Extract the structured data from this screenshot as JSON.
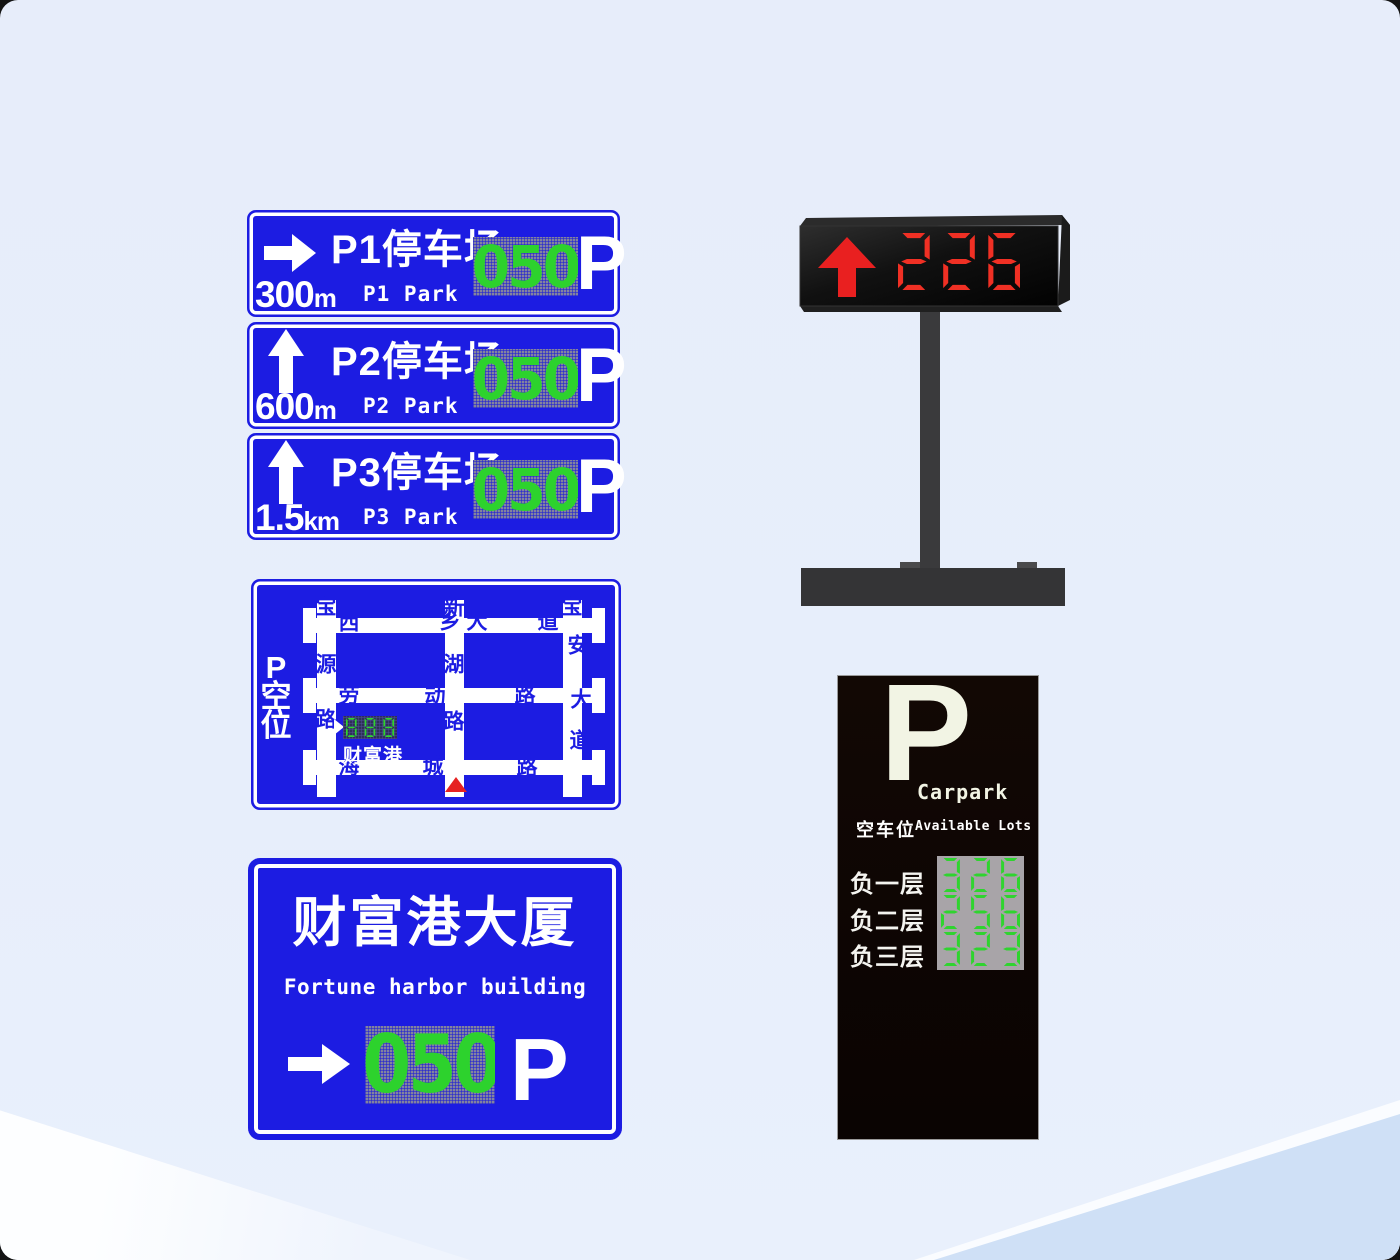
{
  "background": {
    "base": "#e7edfa",
    "wedge_left": "#fdfeff",
    "corner_right": "#cfe0f6"
  },
  "colors": {
    "sign_blue": "#1c1ce2",
    "sign_green": "#2dd22d",
    "led_red": "#f03024",
    "panel_gray": "#83839e",
    "totem_black": "#0d0503",
    "totem_cream": "#f2f4e4",
    "totem_panel_gray": "#a8a4a8",
    "marker_red": "#e62222",
    "pole_gray": "#3a3a3c"
  },
  "direction_signs": [
    {
      "arrow": "right",
      "distance": "300",
      "unit": "m",
      "name_cn": "P1停车场",
      "name_en": "P1 Park",
      "available": "050",
      "parking_symbol": "P"
    },
    {
      "arrow": "up",
      "distance": "600",
      "unit": "m",
      "name_cn": "P2停车场",
      "name_en": "P2 Park",
      "available": "050",
      "parking_symbol": "P"
    },
    {
      "arrow": "up",
      "distance": "1.5",
      "unit": "km",
      "name_cn": "P3停车场",
      "name_en": "P3 Park",
      "available": "050",
      "parking_symbol": "P"
    }
  ],
  "led_display": {
    "arrow": "up",
    "value": "226"
  },
  "map_sign": {
    "side_label": [
      "P",
      "空",
      "位"
    ],
    "led_value": "888",
    "led_site": "财富港",
    "streets": [
      {
        "t": "宝",
        "x": 75,
        "y": 28
      },
      {
        "t": "源",
        "x": 75,
        "y": 86
      },
      {
        "t": "路",
        "x": 75,
        "y": 141
      },
      {
        "t": "新",
        "x": 203,
        "y": 29
      },
      {
        "t": "湖",
        "x": 203,
        "y": 86
      },
      {
        "t": "路",
        "x": 203,
        "y": 143
      },
      {
        "t": "宝",
        "x": 321,
        "y": 28
      },
      {
        "t": "安",
        "x": 327,
        "y": 67
      },
      {
        "t": "大",
        "x": 330,
        "y": 121
      },
      {
        "t": "道",
        "x": 329,
        "y": 162
      },
      {
        "t": "西",
        "x": 98,
        "y": 44
      },
      {
        "t": "乡",
        "x": 199,
        "y": 43
      },
      {
        "t": "大",
        "x": 226,
        "y": 43
      },
      {
        "t": "道",
        "x": 297,
        "y": 43
      },
      {
        "t": "劳",
        "x": 98,
        "y": 117
      },
      {
        "t": "动",
        "x": 184,
        "y": 118
      },
      {
        "t": "路",
        "x": 274,
        "y": 117
      },
      {
        "t": "海",
        "x": 98,
        "y": 188
      },
      {
        "t": "城",
        "x": 182,
        "y": 188
      },
      {
        "t": "路",
        "x": 276,
        "y": 189
      }
    ]
  },
  "building_sign": {
    "title": "财富港大厦",
    "subtitle": "Fortune harbor building",
    "available": "050",
    "parking_symbol": "P"
  },
  "totem": {
    "symbol": "P",
    "title": "Carpark",
    "label_cn": "空车位",
    "label_en": "Available Lots",
    "rows": [
      {
        "label": "负一层",
        "value": "326"
      },
      {
        "label": "负二层",
        "value": "256"
      },
      {
        "label": "负三层",
        "value": "323"
      }
    ]
  }
}
